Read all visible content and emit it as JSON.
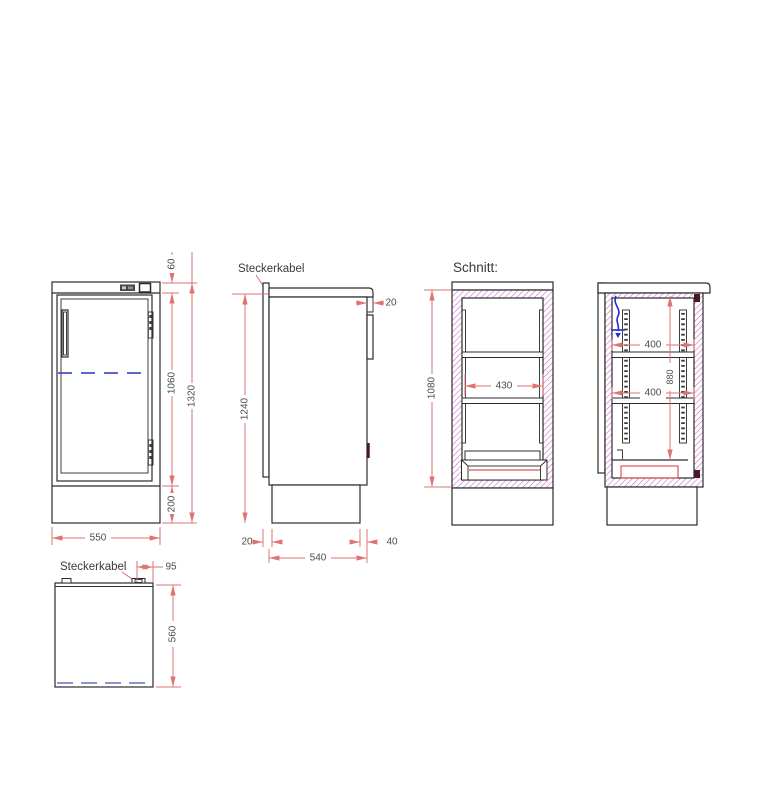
{
  "drawing": {
    "type": "technical-cabinet-drawing",
    "section_title": "Schnitt:",
    "colors": {
      "line": "#2b2b2b",
      "dimension_line": "#dd7373",
      "dimension_text": "#4d4d4d",
      "hatch_magenta": "#cc5fcc",
      "hidden_line_blue": "#4353c4",
      "hidden_line_blue_light": "#8b97c9",
      "cable_blue": "#1f2fd0",
      "detail_red": "#e05555",
      "background": "#ffffff"
    },
    "views": {
      "front": {
        "dim_top_panel": "60",
        "dim_door_height": "1060",
        "dim_total_height": "1320",
        "dim_base_height": "200",
        "dim_width": "550"
      },
      "side": {
        "label_cable": "Steckerkabel",
        "dim_body_height": "1240",
        "dim_door_thickness": "20",
        "dim_base_back_inset": "20",
        "dim_depth": "540",
        "dim_base_front_inset": "40"
      },
      "section_front": {
        "title": "Schnitt:",
        "dim_interior_height": "1080",
        "dim_interior_width": "430"
      },
      "section_side": {
        "dim_shelf_depth_upper": "400",
        "dim_shelf_depth_lower": "400",
        "dim_rail_height": "880"
      },
      "top": {
        "label_cable": "Steckerkabel",
        "dim_cable_offset": "95",
        "dim_depth": "560"
      }
    }
  }
}
